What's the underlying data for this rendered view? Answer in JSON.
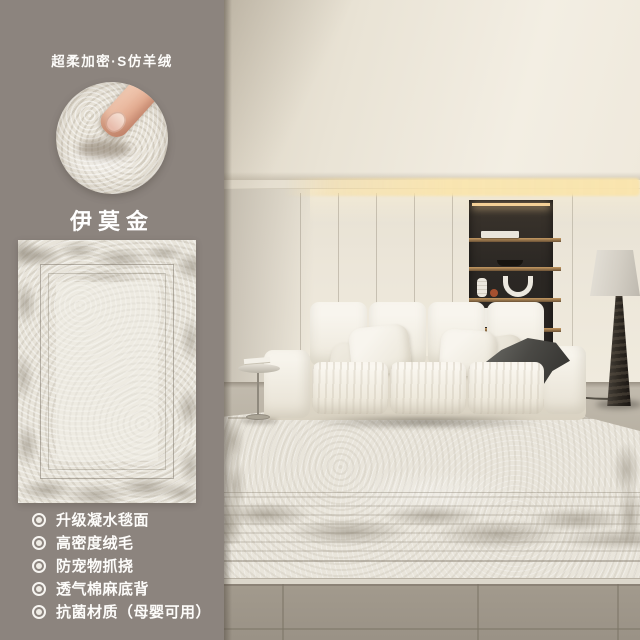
{
  "sidebar": {
    "tagline": "超柔加密·S仿羊绒",
    "product_name": "伊莫金",
    "features": [
      "升级凝水毯面",
      "高密度绒毛",
      "防宠物抓挠",
      "透气棉麻底背",
      "抗菌材质（母婴可用）"
    ]
  },
  "palette": {
    "panel_background": "#8c847e",
    "panel_text": "#ffffff",
    "rug_base": "#e9e5db",
    "rug_distressed": "#867e6f",
    "led_glow": "#f3cf96",
    "shelf_wood": "#c59a62",
    "niche_dark": "#2c2824",
    "tile_floor": "#aaa294"
  }
}
